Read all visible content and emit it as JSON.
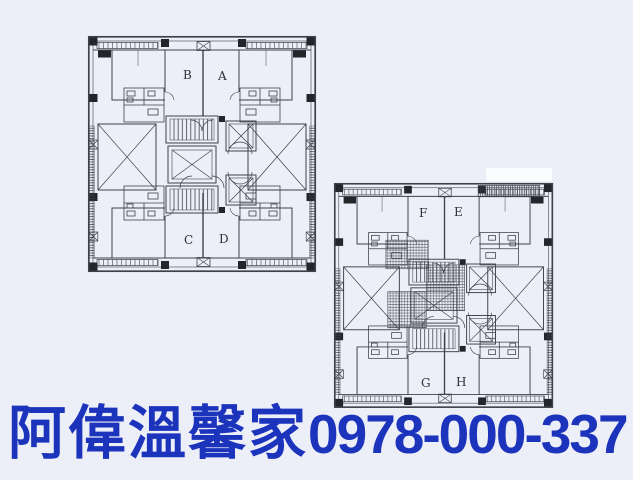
{
  "colors": {
    "background": "#edeff8",
    "plan_ink": "#3d414a",
    "column_black": "#23252b",
    "ad_blue": "#1c33bc",
    "white_patch": "#fbfcfe"
  },
  "plan_upper_left": {
    "units": [
      "B",
      "A",
      "C",
      "D"
    ]
  },
  "plan_lower_right": {
    "units": [
      "F",
      "E",
      "G",
      "H"
    ]
  },
  "ad": {
    "brand": "阿偉溫馨家",
    "phone": "0978-000-337"
  }
}
